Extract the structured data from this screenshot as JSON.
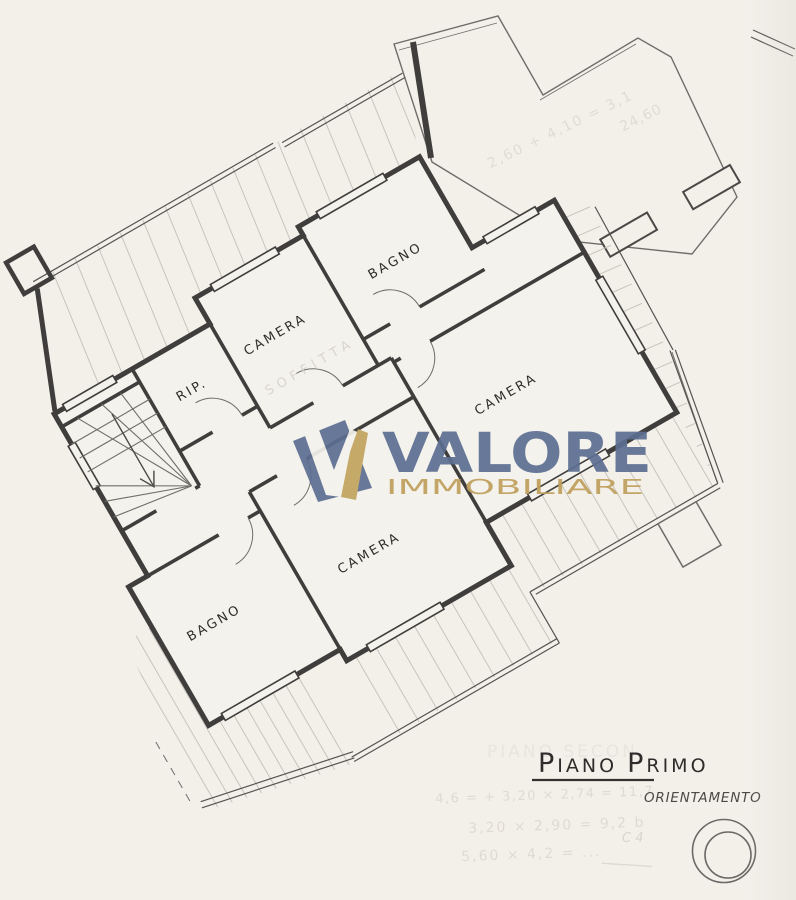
{
  "labels": {
    "bagno_top": "BAGNO",
    "camera_top": "CAMERA",
    "rip": "RIP.",
    "camera_right": "CAMERA",
    "camera_bottom": "CAMERA",
    "bagno_bottom": "BAGNO",
    "soffitta_ghost": "SOFFITTA"
  },
  "title": {
    "word1_initial": "P",
    "word1_rest": "IANO",
    "word2_initial": "P",
    "word2_rest": "RIMO",
    "ghost_behind": "PIANO SECON"
  },
  "orientation": {
    "label": "ORIENTAMENTO"
  },
  "watermark": {
    "brand": "VALORE",
    "subtitle": "IMMOBILIARE",
    "slate_color": "#5d6e92",
    "gold_color": "#c2a35e"
  },
  "pencil_notes": {
    "line1": "4,6 = + 3,20 × 2,74 = 11,7",
    "line2": "3,20 × 2,90 = 9,2 b",
    "line3": "5,60 × 4,2 = ...",
    "terrace_note1": "2,60 + 4,10 = 3,1",
    "terrace_note2": "24,60",
    "compass_side_note": "C 4"
  }
}
